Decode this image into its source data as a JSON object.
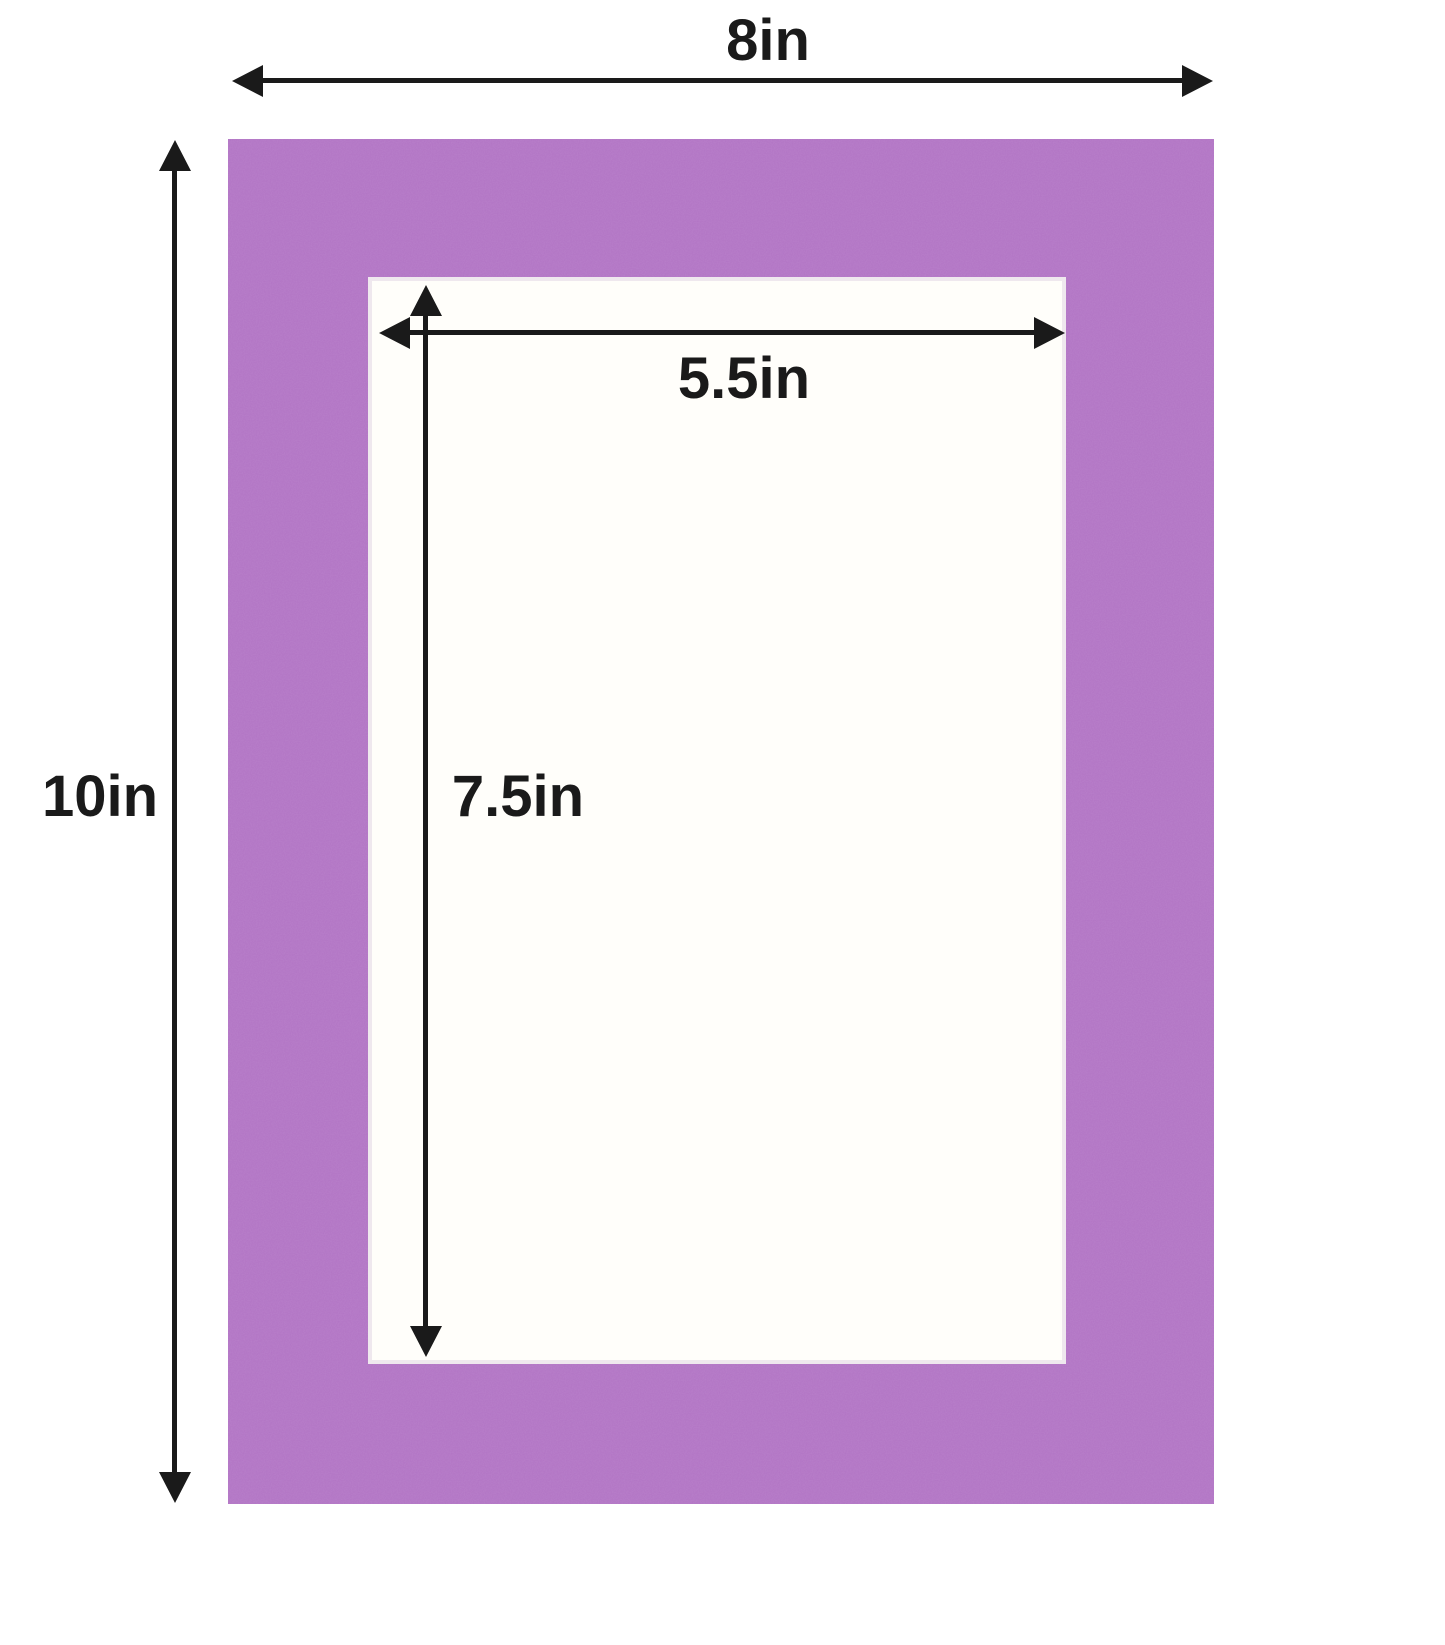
{
  "labels": {
    "outer_width": "8in",
    "outer_height": "10in",
    "opening_width": "5.5in",
    "opening_height": "7.5in"
  },
  "colors": {
    "mat": "#b173c4",
    "opening": "#fffefa",
    "dimension_lines": "#1a1a1a",
    "background": "#ffffff"
  }
}
